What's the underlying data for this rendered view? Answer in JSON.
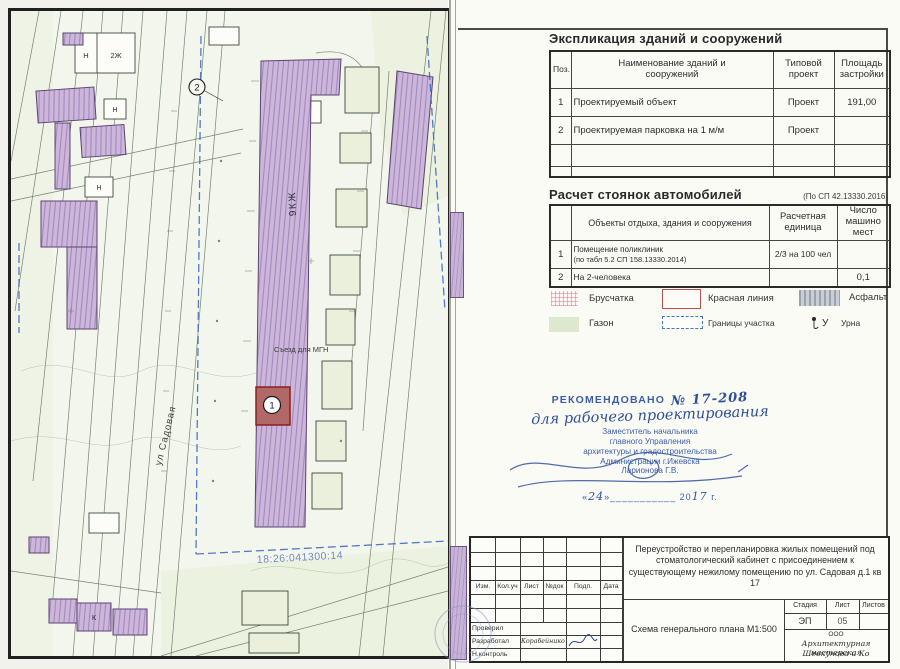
{
  "colors": {
    "purple_building": "#ccb7da",
    "stamp_blue": "#3c5da8",
    "red_marker_border": "#8e1f1f",
    "boundary_blue": "#3f6cc4",
    "cadastral_blue": "#7289c6"
  },
  "map": {
    "label_main_building": "9КЖ",
    "label_ramp": "Съезд для МГН",
    "label_street": "ул Садовая",
    "label_cadastral": "18:26:041300:14",
    "marker_object": "1",
    "marker_parking": "2",
    "label_n": "Н",
    "label_2zh": "2Ж",
    "label_k": "К"
  },
  "explication": {
    "title": "Экспликация зданий и сооружений",
    "col_pos": "Поз.",
    "col_name": "Наименование зданий и сооружений",
    "col_type": "Типовой проект",
    "col_area": "Площадь застройки",
    "rows": [
      {
        "pos": "1",
        "name": "Проектируемый объект",
        "type": "Проект",
        "area": "191,00"
      },
      {
        "pos": "2",
        "name": "Проектируемая парковка на 1 м/м",
        "type": "Проект",
        "area": ""
      },
      {
        "pos": "",
        "name": "",
        "type": "",
        "area": ""
      },
      {
        "pos": "",
        "name": "",
        "type": "",
        "area": ""
      }
    ]
  },
  "parking": {
    "title": "Расчет стоянок автомобилей",
    "note": "(По СП 42.13330.2016)",
    "col_pos": "",
    "col_name": "Объекты отдыха, здания и сооружения",
    "col_unit": "Расчетная единица",
    "col_count": "Число машино мест",
    "rows": [
      {
        "pos": "1",
        "name": "Помещение поликлиник",
        "name2": "(по табл 5.2 СП 158.13330.2014)",
        "unit": "2/3 на 100 чел",
        "count": ""
      },
      {
        "pos": "2",
        "name": "На 2-человека",
        "name2": "",
        "unit": "",
        "count": "0,1"
      }
    ]
  },
  "legend": {
    "bruschatka": "Брусчатка",
    "red_line": "Красная линия",
    "asphalt": "Асфальт",
    "gazon": "Газон",
    "boundary": "Границы участка",
    "urn": "Урна",
    "urn_symbol": "У"
  },
  "stamp": {
    "recommended": "РЕКОМЕНДОВАНО",
    "number": "№ 17-208",
    "handwritten": "для рабочего проектирования",
    "line1": "Заместитель начальника",
    "line2": "главного Управления",
    "line3": "архитектуры и градостроительства",
    "line4": "Администрации г.Ижевска",
    "line5": "Ларионова Г.В.",
    "date_open": "«",
    "date_day": "24",
    "date_mid": "»___________ 20",
    "date_year": "17",
    "date_end": "г."
  },
  "titleblock": {
    "rev_cols": [
      "Изм.",
      "Кол.уч",
      "Лист",
      "№док",
      "Подп.",
      "Дата"
    ],
    "project_title": "Переустройство и перепланировка жилых помещений под стоматологический кабинет с присоединением к существующему нежилому помещению по ул. Садовая д.1 кв 17",
    "stage_label": "Стадия",
    "sheet_label": "Лист",
    "sheets_label": "Листов",
    "stage_value": "ЭП",
    "sheet_value": "05",
    "sheets_value": "",
    "role_checked": "Проверил",
    "role_developed": "Разработал",
    "dev_name": "Корабейников",
    "role_control": "Н.контроль",
    "drawing_name": "Схема генерального плана М1:500",
    "company_type": "ООО",
    "company_line1": "Архитектурная мастерская",
    "company_line2": "Шевкунова и Ко"
  }
}
